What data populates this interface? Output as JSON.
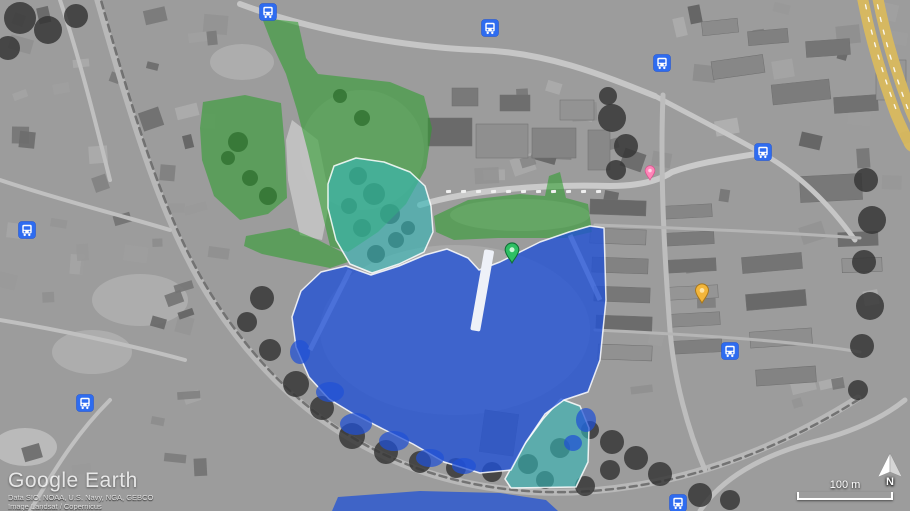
{
  "watermark": {
    "title": "Google Earth",
    "attribution": [
      "Data SIO, NOAA, U.S. Navy, NGA, GEBCO",
      "Image Landsat / Copernicus"
    ]
  },
  "hud": {
    "scale_label": "100 m",
    "compass_label": "N"
  },
  "overlays": {
    "colors": {
      "green": "#2f9e2f",
      "teal": "#35b6b6",
      "blue": "#2051d6",
      "border": "#ffffff"
    },
    "regions": [
      {
        "name": "green-fields-north",
        "color": "green",
        "opacity": 0.58,
        "stroke": false,
        "points": "262,18 298,22 306,58 318,74 390,82 424,96 432,128 426,168 406,204 378,232 348,252 330,246 321,208 308,152 297,110 286,74 272,44"
      },
      {
        "name": "green-field-west",
        "color": "green",
        "opacity": 0.58,
        "stroke": false,
        "points": "203,102 245,95 281,103 285,148 287,198 268,214 240,220 214,196 202,160 200,128"
      },
      {
        "name": "green-band-south",
        "color": "green",
        "opacity": 0.58,
        "stroke": false,
        "points": "246,236 290,228 318,240 342,252 348,262 330,268 300,262 262,254 244,246"
      },
      {
        "name": "green-strip-east",
        "color": "green",
        "opacity": 0.58,
        "stroke": false,
        "points": "434,216 468,200 520,194 545,196 549,176 560,172 566,198 588,204 592,232 566,238 498,238 454,240 436,232"
      },
      {
        "name": "teal-grove",
        "color": "teal",
        "opacity": 0.62,
        "stroke": true,
        "points": "334,166 356,158 384,162 410,172 425,186 431,206 433,232 424,252 399,264 372,273 350,264 336,240 328,208 328,184"
      },
      {
        "name": "teal-triangle-south",
        "color": "teal",
        "opacity": 0.62,
        "stroke": true,
        "points": "561,399 580,406 589,428 588,462 576,487 511,488 505,479 524,445 543,419"
      },
      {
        "name": "blue-main-parcel",
        "color": "blue",
        "opacity": 0.78,
        "stroke": true,
        "points": "590,226 604,228 606,300 600,360 588,392 564,400 545,414 526,442 511,470 480,473 444,462 413,444 383,429 352,413 329,399 309,377 296,347 292,317 301,291 321,272 346,266 371,275 399,266 425,255 447,249 468,258 479,270 500,262 540,242 569,232"
      },
      {
        "name": "blue-south-band",
        "color": "blue",
        "opacity": 0.75,
        "stroke": false,
        "points": "338,497 420,491 500,493 546,500 558,511 332,511"
      }
    ],
    "blue_blobs": [
      [
        330,
        392,
        14,
        10
      ],
      [
        356,
        424,
        16,
        11
      ],
      [
        394,
        441,
        15,
        10
      ],
      [
        300,
        352,
        10,
        12
      ],
      [
        430,
        458,
        14,
        9
      ],
      [
        464,
        466,
        12,
        8
      ],
      [
        586,
        420,
        10,
        12
      ],
      [
        573,
        443,
        9,
        8
      ]
    ]
  },
  "bus_stops": [
    {
      "x": 268,
      "y": 12
    },
    {
      "x": 490,
      "y": 28
    },
    {
      "x": 662,
      "y": 63
    },
    {
      "x": 763,
      "y": 152
    },
    {
      "x": 27,
      "y": 230
    },
    {
      "x": 85,
      "y": 403
    },
    {
      "x": 730,
      "y": 351
    },
    {
      "x": 678,
      "y": 503
    }
  ],
  "markers": [
    {
      "name": "green-pin",
      "fill": "#2fbf63",
      "stroke": "#0e6e34",
      "inner": "#c9f5d6",
      "x": 512,
      "y": 263,
      "h": 21
    },
    {
      "name": "yellow-pin",
      "fill": "#f3b63b",
      "stroke": "#a8771b",
      "inner": "#ffe3a1",
      "x": 702,
      "y": 303,
      "h": 20
    },
    {
      "name": "pink-pin",
      "fill": "#ff85b8",
      "stroke": "#d6538d",
      "inner": "#ffd2e6",
      "x": 650,
      "y": 180,
      "h": 15
    }
  ]
}
